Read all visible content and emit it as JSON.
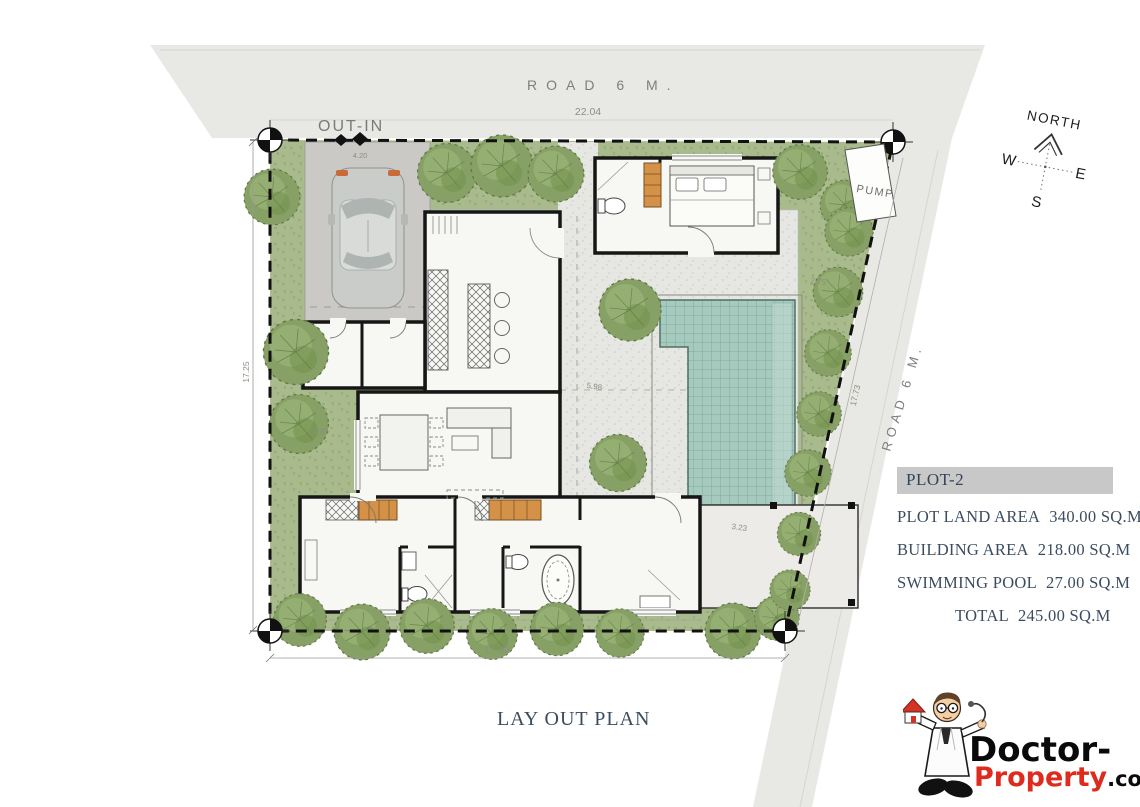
{
  "plan": {
    "labels": {
      "road_top": "ROAD 6 M.",
      "road_right": "ROAD 6 M.",
      "out_in": "OUT-IN",
      "pump": "PUMP"
    },
    "compass": {
      "north": "NORTH",
      "west": "W",
      "east": "E",
      "south": "S"
    },
    "dimensions": {
      "road_frontage_top": "22.04",
      "carport_width": "4.20",
      "side_left": "17.25",
      "setback_left": "3.95",
      "courtyard": "5.98",
      "setback_right_top": "2.75",
      "side_right": "17.73",
      "setback_right_bottom": "3.23",
      "side_bottom": "17.92"
    }
  },
  "info_panel": {
    "title": "PLOT-2",
    "rows": [
      {
        "label": "PLOT LAND AREA",
        "value": "340.00 SQ.M"
      },
      {
        "label": "BUILDING AREA",
        "value": "218.00 SQ.M"
      },
      {
        "label": "SWIMMING POOL",
        "value": "27.00 SQ.M"
      },
      {
        "label": "TOTAL",
        "value": "245.00 SQ.M"
      }
    ]
  },
  "footer": {
    "drawing_title": "LAY OUT PLAN"
  },
  "logo": {
    "part1": "Doctor-",
    "part2": "Property",
    "part3": ".co.th"
  },
  "colors": {
    "grass": "#a9bb8d",
    "pool": "#a7cabf",
    "road": "#e8e8e5",
    "text_accent": "#3c4c5f",
    "wardrobe": "#d49148",
    "logo_red": "#df2b1e"
  }
}
